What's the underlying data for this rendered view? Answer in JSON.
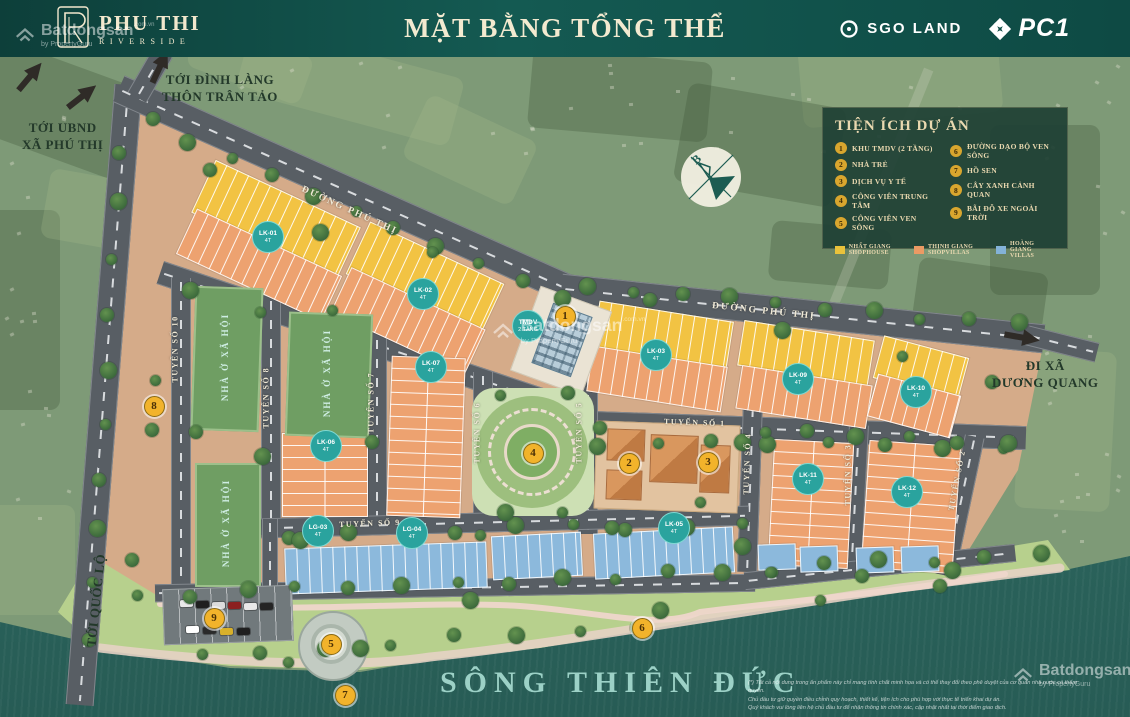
{
  "header": {
    "project_name": "PHU THI",
    "project_subtitle": "RIVERSIDE",
    "title": "MẶT BẰNG TỔNG THỂ",
    "partners": [
      {
        "name": "SGO LAND"
      },
      {
        "name": "PC1"
      }
    ]
  },
  "legend": {
    "title": "TIỆN ÍCH DỰ ÁN",
    "items": [
      {
        "num": "1",
        "label": "KHU TMDV (2 TẦNG)"
      },
      {
        "num": "2",
        "label": "NHÀ TRẺ"
      },
      {
        "num": "3",
        "label": "DỊCH VỤ Y TẾ"
      },
      {
        "num": "4",
        "label": "CÔNG VIÊN TRUNG TÂM"
      },
      {
        "num": "5",
        "label": "CÔNG VIÊN VEN SÔNG"
      },
      {
        "num": "6",
        "label": "ĐƯỜNG DẠO BỘ VEN SÔNG"
      },
      {
        "num": "7",
        "label": "HỒ SEN"
      },
      {
        "num": "8",
        "label": "CÂY XANH CẢNH QUAN"
      },
      {
        "num": "9",
        "label": "BÃI ĐỖ XE NGOÀI TRỜI"
      }
    ],
    "categories": [
      {
        "label": "NHẤT GIANG SHOPHOUSE",
        "color": "#e9c23b"
      },
      {
        "label": "THỊNH GIANG SHOPVILLAS",
        "color": "#eb9a64"
      },
      {
        "label": "HOÀNG GIANG VILLAS",
        "color": "#83b2d8"
      }
    ]
  },
  "map": {
    "river_name": "SÔNG THIÊN ĐỨC",
    "compass_label": "B",
    "social_housing_label": "NHÀ Ở XÃ HỘI",
    "direction_labels": [
      {
        "lines": [
          "TỚI UBND",
          "XÃ PHÚ THỊ"
        ],
        "x": 22,
        "y": 120,
        "rot": 0
      },
      {
        "lines": [
          "TỚI ĐÌNH LÀNG",
          "THÔN TRÂN TẢO"
        ],
        "x": 162,
        "y": 72,
        "rot": 0
      },
      {
        "lines": [
          "ĐI XÃ",
          "DƯƠNG QUANG"
        ],
        "x": 992,
        "y": 358,
        "rot": 0
      },
      {
        "lines": [
          "TỚI QUỐC LỘ"
        ],
        "x": 50,
        "y": 592,
        "rot": -84
      }
    ],
    "road_labels": [
      {
        "text": "ĐƯỜNG PHÚ THỊ",
        "x": 302,
        "y": 184,
        "rot": 24.5,
        "big": true
      },
      {
        "text": "ĐƯỜNG PHÚ THỊ",
        "x": 712,
        "y": 301,
        "rot": 6,
        "big": true
      },
      {
        "text": "TUYẾN SỐ 1",
        "x": 664,
        "y": 417,
        "rot": 2,
        "big": false
      },
      {
        "text": "TUYẾN SỐ 2",
        "x": 951,
        "y": 506,
        "rot": -79,
        "big": false
      },
      {
        "text": "TUYẾN SỐ 3",
        "x": 848,
        "y": 501,
        "rot": -90,
        "big": false
      },
      {
        "text": "TUYẾN SỐ 4",
        "x": 746,
        "y": 490,
        "rot": -88,
        "big": false
      },
      {
        "text": "TUYẾN SỐ 5",
        "x": 579,
        "y": 459,
        "rot": -90,
        "big": false
      },
      {
        "text": "TUYẾN SỐ 6",
        "x": 477,
        "y": 459,
        "rot": -90,
        "big": false
      },
      {
        "text": "TUYẾN SỐ 7",
        "x": 371,
        "y": 429,
        "rot": -90,
        "big": false
      },
      {
        "text": "TUYẾN SỐ 8",
        "x": 266,
        "y": 424,
        "rot": -90,
        "big": false
      },
      {
        "text": "TUYẾN SỐ 9",
        "x": 339,
        "y": 520,
        "rot": -2,
        "big": false
      },
      {
        "text": "TUYẾN SỐ 10",
        "x": 175,
        "y": 378,
        "rot": -90,
        "big": false
      }
    ],
    "amenity_markers": [
      {
        "num": "1",
        "x": 564,
        "y": 315,
        "name": "KHU TMDV (2 TẦNG)"
      },
      {
        "num": "2",
        "x": 628,
        "y": 462,
        "name": "NHÀ TRẺ"
      },
      {
        "num": "3",
        "x": 707,
        "y": 461,
        "name": "DỊCH VỤ Y TẾ"
      },
      {
        "num": "4",
        "x": 532,
        "y": 452,
        "name": "CÔNG VIÊN TRUNG TÂM"
      },
      {
        "num": "5",
        "x": 330,
        "y": 643,
        "name": "CÔNG VIÊN VEN SÔNG"
      },
      {
        "num": "6",
        "x": 641,
        "y": 627,
        "name": "ĐƯỜNG DẠO BỘ VEN SÔNG"
      },
      {
        "num": "7",
        "x": 344,
        "y": 694,
        "name": "HỒ SEN"
      },
      {
        "num": "8",
        "x": 153,
        "y": 405,
        "name": "CÂY XANH CẢNH QUAN"
      },
      {
        "num": "9",
        "x": 213,
        "y": 617,
        "name": "BÃI ĐỖ XE NGOÀI TRỜI"
      }
    ],
    "block_markers": [
      {
        "code": "TMDV",
        "sub": "2 TẦNG",
        "x": 527,
        "y": 325
      },
      {
        "code": "LK-01",
        "sub": "4T",
        "x": 267,
        "y": 236
      },
      {
        "code": "LK-02",
        "sub": "4T",
        "x": 422,
        "y": 293
      },
      {
        "code": "LK-03",
        "sub": "4T",
        "x": 655,
        "y": 354
      },
      {
        "code": "LK-05",
        "sub": "4T",
        "x": 673,
        "y": 527
      },
      {
        "code": "LK-06",
        "sub": "4T",
        "x": 325,
        "y": 445
      },
      {
        "code": "LK-07",
        "sub": "4T",
        "x": 430,
        "y": 366
      },
      {
        "code": "LK-09",
        "sub": "4T",
        "x": 797,
        "y": 378
      },
      {
        "code": "LK-10",
        "sub": "4T",
        "x": 915,
        "y": 391
      },
      {
        "code": "LK-11",
        "sub": "4T",
        "x": 807,
        "y": 478
      },
      {
        "code": "LK-12",
        "sub": "4T",
        "x": 906,
        "y": 491
      },
      {
        "code": "LG-03",
        "sub": "4T",
        "x": 317,
        "y": 530
      },
      {
        "code": "LG-04",
        "sub": "4T",
        "x": 411,
        "y": 532
      }
    ],
    "lot_sizes_sample": {
      "shophouse": [
        "106.6",
        "75.0",
        "73.9",
        "75.0",
        "89.8",
        "99.7"
      ],
      "shopvillas": [
        "73.8",
        "73.7",
        "81.0",
        "94.5",
        "105.3",
        "125.5",
        "93.9",
        "36.7",
        "88.3"
      ],
      "villas": [
        "134.2",
        "118.8",
        "112.8",
        "132.7",
        "140.0",
        "150.0",
        "133.8",
        "129.7",
        "199.9",
        "199.0"
      ]
    },
    "watermark": {
      "brand": "Batdongsan",
      "suffix": ".com.vn",
      "sub": "by PropertyGuru"
    },
    "disclaimer_lines": [
      "(*) Tất cả nội dung trong ấn phẩm này chỉ mang tính chất minh họa và có thể thay đổi theo phê duyệt của cơ quan nhà nước có thẩm quyền.",
      "Chủ đầu tư giữ quyền điều chỉnh quy hoạch, thiết kế, tiện ích cho phù hợp với thực tế triển khai dự án.",
      "Quý khách vui lòng liên hệ chủ đầu tư để nhận thông tin chính xác, cập nhật nhất tại thời điểm giao dịch."
    ]
  }
}
